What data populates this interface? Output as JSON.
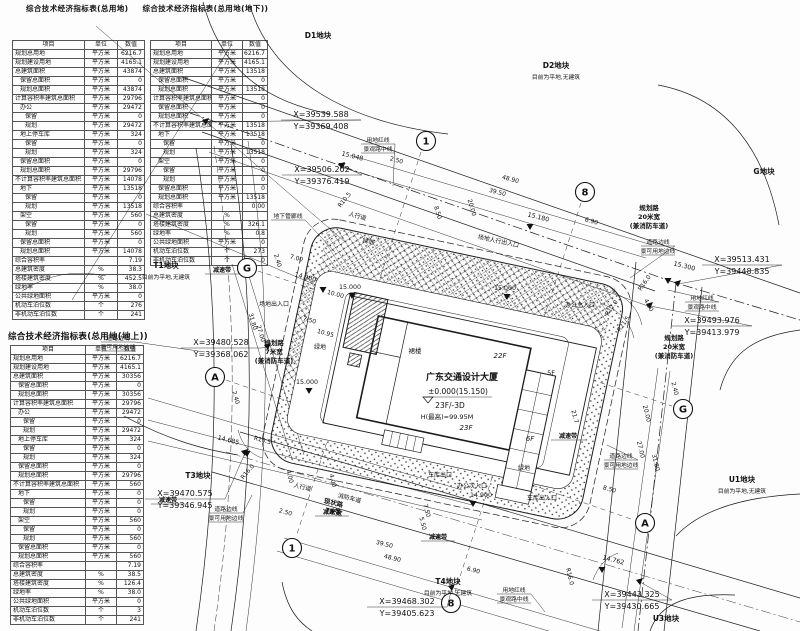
{
  "titles": {
    "t1": "综合技术经济指标表(总用地)",
    "t2": "综合技术经济指标表(总用地(地下))",
    "t3": "综合技术经济指标表(总用地(地上))"
  },
  "tables": {
    "total": {
      "headers": [
        "项目",
        "单位",
        "数值"
      ],
      "rows": [
        [
          "规划总用地",
          "平方米",
          "6216.7",
          0
        ],
        [
          "规划建设用地",
          "平方米",
          "4165.1",
          0
        ],
        [
          "总建筑面积",
          "平方米",
          "43874",
          0
        ],
        [
          "保留总面积",
          "平方米",
          "0",
          1
        ],
        [
          "规划总面积",
          "平方米",
          "43874",
          1
        ],
        [
          "计算容积率建筑总面积",
          "平方米",
          "29796",
          0
        ],
        [
          "办公",
          "平方米",
          "29472",
          1
        ],
        [
          "保留",
          "平方米",
          "0",
          2
        ],
        [
          "规划",
          "平方米",
          "29472",
          2
        ],
        [
          "地上停车库",
          "平方米",
          "324",
          1
        ],
        [
          "保留",
          "平方米",
          "0",
          2
        ],
        [
          "规划",
          "平方米",
          "324",
          2
        ],
        [
          "保留总面积",
          "平方米",
          "0",
          1
        ],
        [
          "规划总面积",
          "平方米",
          "29796",
          1
        ],
        [
          "不计算容积率建筑总面积",
          "平方米",
          "14078",
          0
        ],
        [
          "地下",
          "平方米",
          "13518",
          1
        ],
        [
          "保留",
          "平方米",
          "0",
          2
        ],
        [
          "规划",
          "平方米",
          "13518",
          2
        ],
        [
          "架空",
          "平方米",
          "560",
          1
        ],
        [
          "保留",
          "平方米",
          "0",
          2
        ],
        [
          "规划",
          "平方米",
          "560",
          2
        ],
        [
          "保留总面积",
          "平方米",
          "0",
          1
        ],
        [
          "规划总面积",
          "平方米",
          "14078",
          1
        ],
        [
          "综合容积率",
          "",
          "7.19",
          0
        ],
        [
          "总建筑密度",
          "%",
          "38.3",
          0
        ],
        [
          "塔楼建筑密度",
          "%",
          "452.5",
          0
        ],
        [
          "绿地率",
          "%",
          "38.0",
          0
        ],
        [
          "公共绿地面积",
          "平方米",
          "0",
          0
        ],
        [
          "机动车泊位数",
          "个",
          "276",
          0
        ],
        [
          "非机动车泊位数",
          "个",
          "241",
          0
        ]
      ]
    },
    "underground": {
      "headers": [
        "项目",
        "单位",
        "数值"
      ],
      "rows": [
        [
          "规划总用地",
          "平方米",
          "6216.7",
          0
        ],
        [
          "规划建设用地",
          "平方米",
          "4165.1",
          0
        ],
        [
          "总建筑面积",
          "平方米",
          "13518",
          0
        ],
        [
          "保留总面积",
          "平方米",
          "0",
          1
        ],
        [
          "规划总面积",
          "平方米",
          "13518",
          1
        ],
        [
          "计算容积率建筑总面积",
          "平方米",
          "0",
          0
        ],
        [
          "保留总面积",
          "平方米",
          "0",
          1
        ],
        [
          "规划总面积",
          "平方米",
          "0",
          1
        ],
        [
          "不计算容积率建筑总面积",
          "平方米",
          "13518",
          0
        ],
        [
          "地下",
          "平方米",
          "13518",
          1
        ],
        [
          "保留",
          "平方米",
          "0",
          2
        ],
        [
          "规划",
          "平方米",
          "13518",
          2
        ],
        [
          "架空",
          "平方米",
          "0",
          1
        ],
        [
          "保留",
          "平方米",
          "0",
          2
        ],
        [
          "规划",
          "平方米",
          "0",
          2
        ],
        [
          "保留总面积",
          "平方米",
          "0",
          1
        ],
        [
          "规划总面积",
          "平方米",
          "13518",
          1
        ],
        [
          "综合容积率",
          "",
          "0.00",
          0
        ],
        [
          "总建筑密度",
          "%",
          "",
          0
        ],
        [
          "塔楼建筑密度",
          "%",
          "326.1",
          0
        ],
        [
          "绿地率",
          "%",
          "0.8",
          0
        ],
        [
          "公共绿地面积",
          "平方米",
          "0",
          0
        ],
        [
          "机动车泊位数",
          "个",
          "273",
          0
        ],
        [
          "非机动车泊位数",
          "个",
          "0",
          0
        ]
      ]
    },
    "above": {
      "headers": [
        "项目",
        "单位",
        "数值"
      ],
      "rows": [
        [
          "规划总用地",
          "平方米",
          "6216.7",
          0
        ],
        [
          "规划建设用地",
          "平方米",
          "4165.1",
          0
        ],
        [
          "总建筑面积",
          "平方米",
          "30356",
          0
        ],
        [
          "保留总面积",
          "平方米",
          "0",
          1
        ],
        [
          "规划总面积",
          "平方米",
          "30356",
          1
        ],
        [
          "计算容积率建筑总面积",
          "平方米",
          "29796",
          0
        ],
        [
          "办公",
          "平方米",
          "29472",
          1
        ],
        [
          "保留",
          "平方米",
          "0",
          2
        ],
        [
          "规划",
          "平方米",
          "29472",
          2
        ],
        [
          "地上停车库",
          "平方米",
          "324",
          1
        ],
        [
          "保留",
          "平方米",
          "0",
          2
        ],
        [
          "规划",
          "平方米",
          "324",
          2
        ],
        [
          "保留总面积",
          "平方米",
          "0",
          1
        ],
        [
          "规划总面积",
          "平方米",
          "29796",
          1
        ],
        [
          "不计算容积率建筑总面积",
          "平方米",
          "560",
          0
        ],
        [
          "地下",
          "平方米",
          "0",
          1
        ],
        [
          "保留",
          "平方米",
          "0",
          2
        ],
        [
          "规划",
          "平方米",
          "0",
          2
        ],
        [
          "架空",
          "平方米",
          "560",
          1
        ],
        [
          "保留",
          "平方米",
          "0",
          2
        ],
        [
          "规划",
          "平方米",
          "560",
          2
        ],
        [
          "保留总面积",
          "平方米",
          "0",
          1
        ],
        [
          "规划总面积",
          "平方米",
          "560",
          1
        ],
        [
          "综合容积率",
          "",
          "7.19",
          0
        ],
        [
          "总建筑密度",
          "%",
          "38.5",
          0
        ],
        [
          "塔楼建筑密度",
          "%",
          "126.4",
          0
        ],
        [
          "绿地率",
          "%",
          "38.0",
          0
        ],
        [
          "公共绿地面积",
          "平方米",
          "0",
          0
        ],
        [
          "机动车泊位数",
          "个",
          "3",
          0
        ],
        [
          "非机动车泊位数",
          "个",
          "241",
          0
        ]
      ]
    }
  },
  "plan": {
    "blocks": [
      {
        "name": "D1地块",
        "x": 318,
        "y": 38
      },
      {
        "name": "D2地块",
        "sub": "目前为平地,无建筑",
        "x": 556,
        "y": 68
      },
      {
        "name": "G地块",
        "x": 764,
        "y": 174
      },
      {
        "name": "T1地块",
        "sub": "目前为平地,无建筑",
        "x": 166,
        "y": 268
      },
      {
        "name": "T3地块",
        "x": 198,
        "y": 478
      },
      {
        "name": "T4地块",
        "sub": "目前为平地,无建筑",
        "x": 448,
        "y": 584
      },
      {
        "name": "U1地块",
        "sub": "目前为平地,无建筑",
        "x": 742,
        "y": 482
      },
      {
        "name": "U3地块",
        "x": 666,
        "y": 621
      }
    ],
    "coords": [
      {
        "x": 321,
        "y": 117,
        "xv": "X=39539.588",
        "yv": "Y=39369.408",
        "tx": 206,
        "ty": 122
      },
      {
        "x": 322,
        "y": 172,
        "xv": "X=39506.202",
        "yv": "Y=39376.419",
        "tx": 342,
        "ty": 166
      },
      {
        "x": 742,
        "y": 262,
        "xv": "X=39513.431",
        "yv": "Y=39448.835",
        "tx": 678,
        "ty": 284
      },
      {
        "x": 712,
        "y": 323,
        "xv": "X=39493.976",
        "yv": "Y=39413.979",
        "tx": 650,
        "ty": 306
      },
      {
        "x": 221,
        "y": 345,
        "xv": "X=39480.528",
        "yv": "Y=39368.062",
        "tx": 268,
        "ty": 347
      },
      {
        "x": 185,
        "y": 496,
        "xv": "X=39470.575",
        "yv": "Y=39346.945",
        "tx": 245,
        "ty": 453
      },
      {
        "x": 407,
        "y": 604,
        "xv": "X=39468.302",
        "yv": "Y=39405.623",
        "tx": 452,
        "ty": 588
      },
      {
        "x": 632,
        "y": 597,
        "xv": "X=39443.325",
        "yv": "Y=39430.665",
        "tx": 640,
        "ty": 582
      }
    ],
    "axes": [
      {
        "s": "1",
        "x": 426,
        "y": 141
      },
      {
        "s": "8",
        "x": 585,
        "y": 192
      },
      {
        "s": "G",
        "x": 247,
        "y": 268
      },
      {
        "s": "A",
        "x": 215,
        "y": 377
      },
      {
        "s": "G",
        "x": 683,
        "y": 409
      },
      {
        "s": "A",
        "x": 645,
        "y": 523
      },
      {
        "s": "1",
        "x": 292,
        "y": 548
      },
      {
        "s": "8",
        "x": 451,
        "y": 603
      }
    ],
    "building": [
      {
        "t": "裙楼",
        "x": 415,
        "y": 353,
        "c": "sm"
      },
      {
        "t": "22F",
        "x": 500,
        "y": 358,
        "c": "fl"
      },
      {
        "t": "广东交通设计大厦",
        "x": 462,
        "y": 380,
        "c": "bt"
      },
      {
        "t": "±0.000(15.150)",
        "x": 458,
        "y": 394,
        "c": "bm"
      },
      {
        "t": "23F/-3D",
        "x": 450,
        "y": 408,
        "c": "bm"
      },
      {
        "t": "H(最高)=99.95M",
        "x": 447,
        "y": 419,
        "c": "bs"
      },
      {
        "t": "23F",
        "x": 466,
        "y": 430,
        "c": "fl"
      },
      {
        "t": "6F",
        "x": 530,
        "y": 441,
        "c": "fl"
      },
      {
        "t": "5F",
        "x": 551,
        "y": 375,
        "c": "sm"
      }
    ],
    "road_groups": [
      {
        "lines": [
          "规划路",
          "20米宽",
          "(兼消防车道)"
        ],
        "x": 649,
        "y": 210
      },
      {
        "lines": [
          "规划路",
          "20米宽",
          "(兼消防车道)"
        ],
        "x": 674,
        "y": 340
      },
      {
        "lines": [
          "规划路",
          "7米宽",
          "(兼消防车道)"
        ],
        "x": 274,
        "y": 345
      },
      {
        "lines": [
          "现状路",
          "7米宽"
        ],
        "x": 333,
        "y": 505,
        "r": 13
      }
    ],
    "boxed": [
      {
        "lines": [
          "用地红线",
          "景观路中线"
        ],
        "x": 378,
        "y": 142,
        "lead": [
          393,
          186
        ]
      },
      {
        "lines": [
          "用地红线",
          "景观路中线"
        ],
        "x": 702,
        "y": 300,
        "lead": [
          668,
          290
        ]
      },
      {
        "lines": [
          "用地红线",
          "景观路中线"
        ],
        "x": 514,
        "y": 592,
        "lead": [
          545,
          612
        ]
      },
      {
        "lines": [
          "道路边线",
          "景可用地边线"
        ],
        "x": 658,
        "y": 244,
        "lead": [
          630,
          278
        ]
      },
      {
        "lines": [
          "道路边线",
          "景可用地边线"
        ],
        "x": 118,
        "y": 340,
        "lead": [
          205,
          352
        ]
      },
      {
        "lines": [
          "道路边线",
          "景可用地边线"
        ],
        "x": 226,
        "y": 511,
        "lead": [
          252,
          495
        ]
      },
      {
        "lines": [
          "道路边线",
          "景可用地边线"
        ],
        "x": 621,
        "y": 458,
        "lead": [
          607,
          445
        ]
      },
      {
        "lines": [
          "地下管廊线"
        ],
        "x": 288,
        "y": 218,
        "lead": [
          335,
          252
        ]
      },
      {
        "lines": [
          "减速带"
        ],
        "x": 222,
        "y": 272,
        "bold": true
      },
      {
        "lines": [
          "减速带"
        ],
        "x": 332,
        "y": 514,
        "bold": true
      },
      {
        "lines": [
          "减速带"
        ],
        "x": 568,
        "y": 438,
        "bold": true
      },
      {
        "lines": [
          "减速带"
        ],
        "x": 438,
        "y": 539,
        "bold": true
      },
      {
        "lines": [
          "减速带"
        ],
        "x": 168,
        "y": 502,
        "bold": true
      }
    ],
    "labels": [
      {
        "t": "人行道",
        "x": 357,
        "y": 218,
        "r": 15
      },
      {
        "t": "人行道",
        "x": 302,
        "y": 489,
        "r": 14
      },
      {
        "t": "消防车道",
        "x": 349,
        "y": 500,
        "r": 14
      },
      {
        "t": "绿地",
        "x": 368,
        "y": 243,
        "r": 15
      },
      {
        "t": "绿地",
        "x": 320,
        "y": 349
      },
      {
        "t": "绿地",
        "x": 524,
        "y": 470
      },
      {
        "t": "车库出口",
        "x": 440,
        "y": 477
      },
      {
        "t": "办公次入口",
        "x": 472,
        "y": 488
      },
      {
        "t": "车库出入口",
        "x": 542,
        "y": 500
      },
      {
        "t": "办公主入口",
        "x": 580,
        "y": 307
      },
      {
        "t": "场地人行出入口",
        "x": 498,
        "y": 243,
        "r": 12
      },
      {
        "t": "场地出入口",
        "x": 274,
        "y": 306
      }
    ],
    "elev": [
      {
        "t": "15.048",
        "x": 352,
        "y": 158,
        "r": 14,
        "tx": 342,
        "ty": 167
      },
      {
        "t": "15.180",
        "x": 538,
        "y": 219,
        "r": 14,
        "tx": 530,
        "ty": 228
      },
      {
        "t": "15.300",
        "x": 684,
        "y": 268,
        "r": 14,
        "tx": 668,
        "ty": 282
      },
      {
        "t": "14.900",
        "x": 305,
        "y": 279,
        "r": 14,
        "tx": 323,
        "ty": 291
      },
      {
        "t": "15.000",
        "x": 350,
        "y": 289,
        "tx": 352,
        "ty": 297
      },
      {
        "t": "15.000",
        "x": 505,
        "y": 290,
        "tx": 507,
        "ty": 298
      },
      {
        "t": "15.000",
        "x": 307,
        "y": 384,
        "tx": 309,
        "ty": 392
      },
      {
        "t": "14.685",
        "x": 228,
        "y": 442,
        "r": 14,
        "tx": 247,
        "ty": 455
      },
      {
        "t": "14.762",
        "x": 613,
        "y": 562,
        "r": 14,
        "tx": 602,
        "ty": 571
      },
      {
        "t": "14.900",
        "x": 481,
        "y": 497,
        "tx": 473,
        "ty": 505
      }
    ],
    "dims": [
      {
        "t": "2.50",
        "x": 396,
        "y": 162,
        "r": 15
      },
      {
        "t": "48.90",
        "x": 510,
        "y": 181,
        "r": 15
      },
      {
        "t": "39.50",
        "x": 497,
        "y": 194,
        "r": 15
      },
      {
        "t": "20.00",
        "x": 470,
        "y": 208,
        "r": 74
      },
      {
        "t": "8.50",
        "x": 436,
        "y": 213,
        "r": 74
      },
      {
        "t": "6.90",
        "x": 591,
        "y": 223,
        "r": 15
      },
      {
        "t": "R10.5",
        "x": 346,
        "y": 201,
        "r": -52
      },
      {
        "t": "R16.0",
        "x": 646,
        "y": 284,
        "r": -55
      },
      {
        "t": "R12.0",
        "x": 613,
        "y": 309,
        "r": -55
      },
      {
        "t": "R21.5",
        "x": 625,
        "y": 325,
        "r": -55
      },
      {
        "t": "4.00",
        "x": 647,
        "y": 306,
        "r": 62
      },
      {
        "t": "2.40",
        "x": 673,
        "y": 389,
        "r": 76
      },
      {
        "t": "20.00",
        "x": 645,
        "y": 414,
        "r": 76
      },
      {
        "t": "27.00",
        "x": 639,
        "y": 450,
        "r": 76
      },
      {
        "t": "31.80",
        "x": 654,
        "y": 463,
        "r": 76
      },
      {
        "t": "8.50",
        "x": 609,
        "y": 491,
        "r": 15
      },
      {
        "t": "R16.0",
        "x": 568,
        "y": 577,
        "r": 76
      },
      {
        "t": "R16.0",
        "x": 249,
        "y": 473,
        "r": -50
      },
      {
        "t": "R10.5",
        "x": 262,
        "y": 442,
        "r": 15
      },
      {
        "t": "2.50",
        "x": 285,
        "y": 514,
        "r": 15
      },
      {
        "t": "4.00",
        "x": 288,
        "y": 477,
        "r": 76
      },
      {
        "t": "39.50",
        "x": 384,
        "y": 546,
        "r": 14
      },
      {
        "t": "48.90",
        "x": 392,
        "y": 560,
        "r": 14
      },
      {
        "t": "6.90",
        "x": 473,
        "y": 572,
        "r": 14
      },
      {
        "t": "2.40",
        "x": 234,
        "y": 398,
        "r": 74
      },
      {
        "t": "31.80",
        "x": 251,
        "y": 322,
        "r": 74
      },
      {
        "t": "27.00",
        "x": 259,
        "y": 334,
        "r": 74
      },
      {
        "t": "7.00",
        "x": 296,
        "y": 260,
        "r": 15
      },
      {
        "t": "2.40",
        "x": 276,
        "y": 261,
        "r": 74
      },
      {
        "t": "10.00",
        "x": 335,
        "y": 296,
        "r": 15
      },
      {
        "t": "10.95",
        "x": 325,
        "y": 335,
        "r": 15
      },
      {
        "t": "7.50",
        "x": 309,
        "y": 322,
        "r": 15
      },
      {
        "t": "7.50",
        "x": 425,
        "y": 511,
        "r": 76
      },
      {
        "t": "5.50",
        "x": 421,
        "y": 524,
        "r": 76
      },
      {
        "t": "4.00",
        "x": 331,
        "y": 481,
        "r": 76
      },
      {
        "t": "21.7",
        "x": 573,
        "y": 417,
        "r": 76
      }
    ]
  },
  "colors": {
    "ink": "#1b1b1b",
    "paper": "#fdfdfd"
  }
}
